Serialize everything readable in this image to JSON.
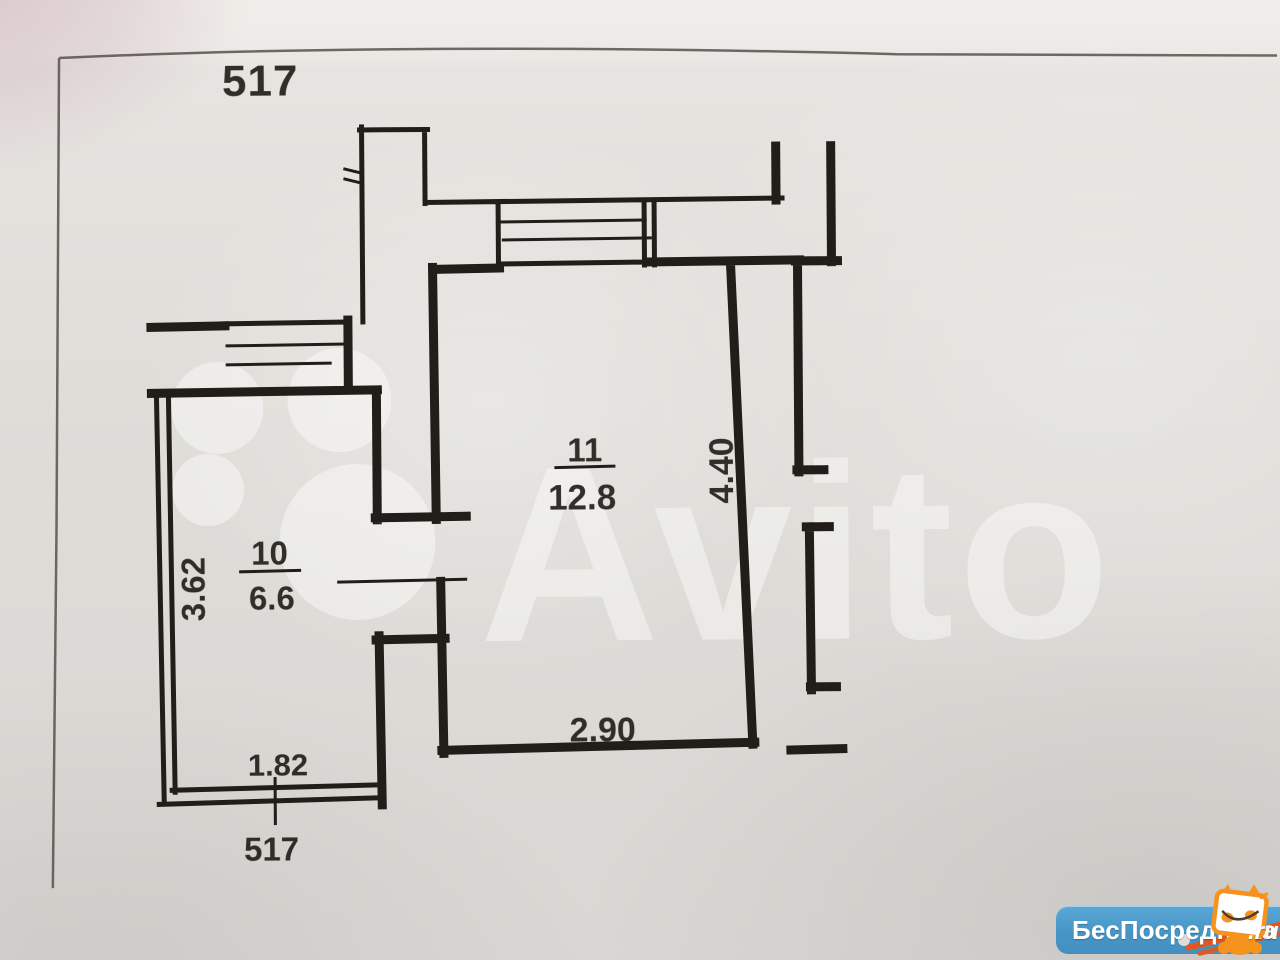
{
  "sheet": {
    "number_top": "517",
    "number_bottom": "517"
  },
  "rooms": [
    {
      "number": "10",
      "area": "6.6"
    },
    {
      "number": "11",
      "area": "12.8"
    }
  ],
  "dimensions": {
    "room10_height": "3.62",
    "room10_width": "1.82",
    "room11_height": "4.40",
    "room11_width": "2.90"
  },
  "watermark": {
    "brand": "Avito"
  },
  "footer_logo": {
    "name": "БесПосредника",
    "tld": ".ru"
  },
  "colors": {
    "ink": "#211d19",
    "paper": "#dedcd7",
    "frame": "#55524c",
    "watermark_white": "#ffffff",
    "logo_blue": "#4795c6",
    "logo_orange": "#f6921e",
    "stripe_red": "#e2571c"
  }
}
